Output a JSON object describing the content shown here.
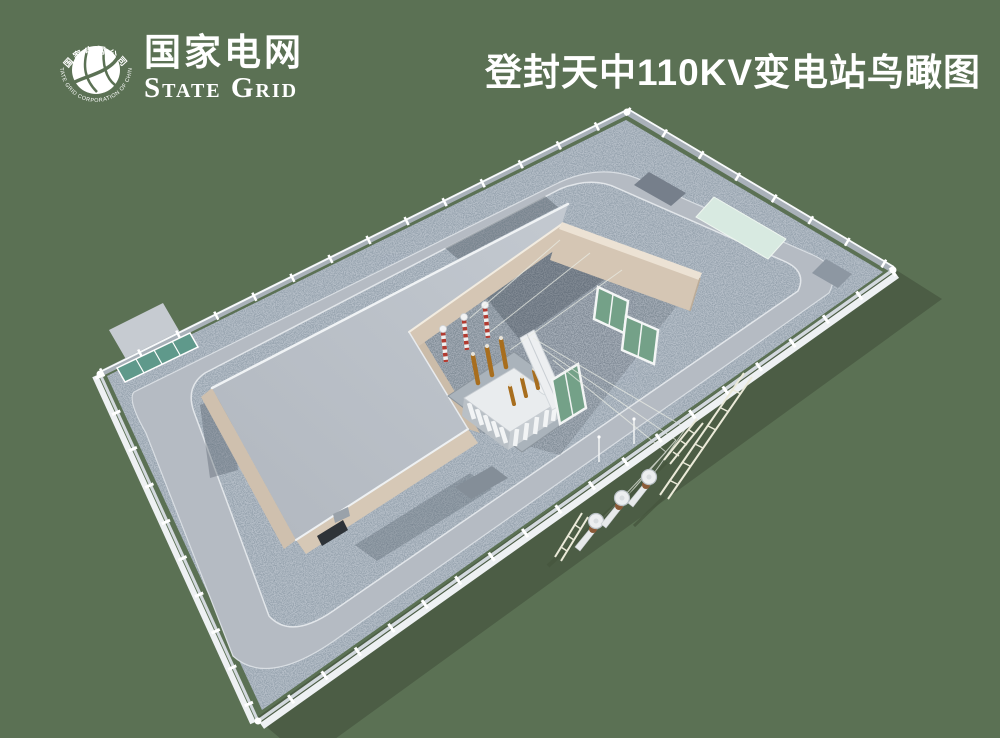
{
  "header": {
    "title": "登封天中110KV变电站鸟瞰图",
    "logo": {
      "name_cn": "国家电网",
      "name_en": "State Grid",
      "emblem_ring_cn": "国家电网公司",
      "emblem_ring_en": "STATE GRID CORPORATION OF CHINA"
    }
  },
  "scene": {
    "colors": {
      "background": "#5b7154",
      "ground_shadow": "#4c5d45",
      "gravel": "#95a2ae",
      "road": "#b5bbc3",
      "roof": "#b9bfc7",
      "wall_beige": "#d5c6b4",
      "gate_teal": "#5f998b",
      "rack_green": "#74a188",
      "mint_pad": "#d8eae1",
      "bushing_copper": "#a86e1e",
      "arrester_red": "#b23b31",
      "fence_white": "#ffffff"
    }
  }
}
